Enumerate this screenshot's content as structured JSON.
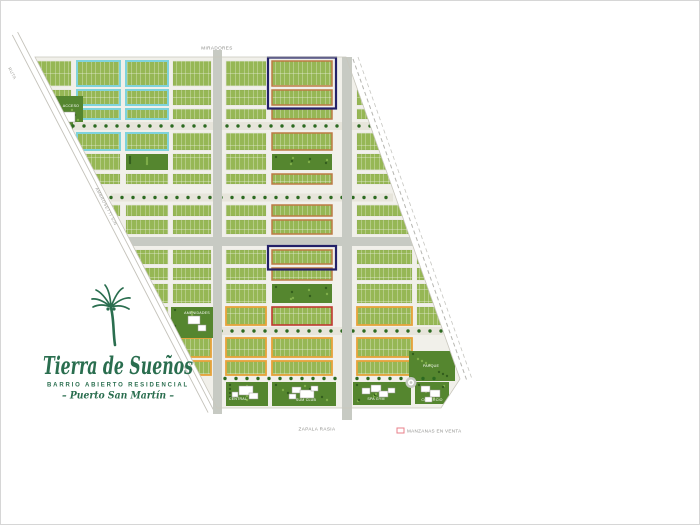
{
  "logo": {
    "title": "Tierra de Sueños",
    "subtitle": "BARRIO ABIERTO RESIDENCIAL",
    "location": "– Puerto San Martín –"
  },
  "roads": {
    "top": "MIRADORES",
    "bottom": "ZAPALA RASIA",
    "left_diagonal": "AMBROSETTI S/N",
    "corner": "RUTA"
  },
  "legend": {
    "swatch_color": "#e87f8a",
    "label": "MANZANAS EN VENTA"
  },
  "map_labels": {
    "portal_top": "ACCESO",
    "amenities_left": "AMENIDADES",
    "amenity_1": "CENTRAL",
    "amenity_2": "SUM CLUB",
    "amenity_3": "SPA GYM",
    "amenity_4": "COMERCIO",
    "corner_park": "PARQUE"
  },
  "colors": {
    "block_green": "#96b755",
    "park_green": "#55862f",
    "road_gray": "#c7cac3",
    "street": "#f1f0ea",
    "cyan": "#7fd3dc",
    "sienna": "#bd7a45",
    "orange": "#e8a33b",
    "navy": "#232168",
    "crimson": "#c03a31"
  }
}
